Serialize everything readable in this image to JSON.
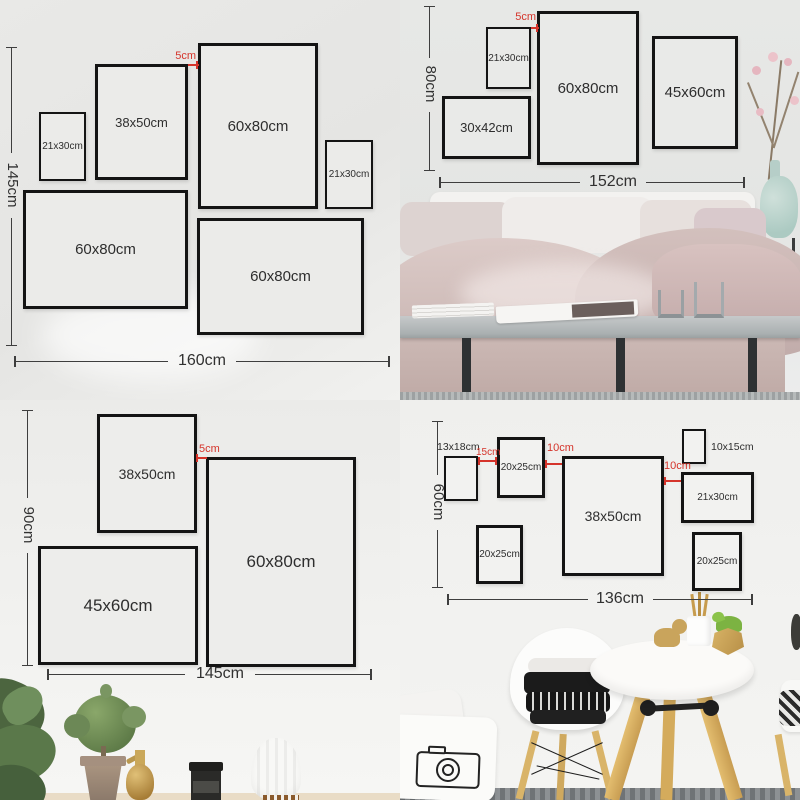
{
  "colors": {
    "accent_red": "#d5342b",
    "dim_line": "#3e3e3e",
    "frame_border": "#141414",
    "wall": "#ebebe9"
  },
  "tl": {
    "frames": [
      "21x30cm",
      "38x50cm",
      "60x80cm",
      "21x30cm",
      "60x80cm",
      "60x80cm"
    ],
    "gap": "5cm",
    "width_total": "160cm",
    "height_total": "145cm"
  },
  "tr": {
    "frames": [
      "21x30cm",
      "60x80cm",
      "45x60cm",
      "30x42cm"
    ],
    "gap": "5cm",
    "width_total": "152cm",
    "height_total": "80cm"
  },
  "bl": {
    "frames": [
      "38x50cm",
      "60x80cm",
      "45x60cm"
    ],
    "gap": "5cm",
    "width_total": "145cm",
    "height_total": "90cm"
  },
  "br": {
    "frames": [
      "13x18cm",
      "20x25cm",
      "38x50cm",
      "10x15cm",
      "21x30cm",
      "20x25cm",
      "20x25cm"
    ],
    "gaps": [
      "15cm",
      "10cm",
      "10cm"
    ],
    "width_total": "136cm",
    "height_total": "60cm"
  }
}
